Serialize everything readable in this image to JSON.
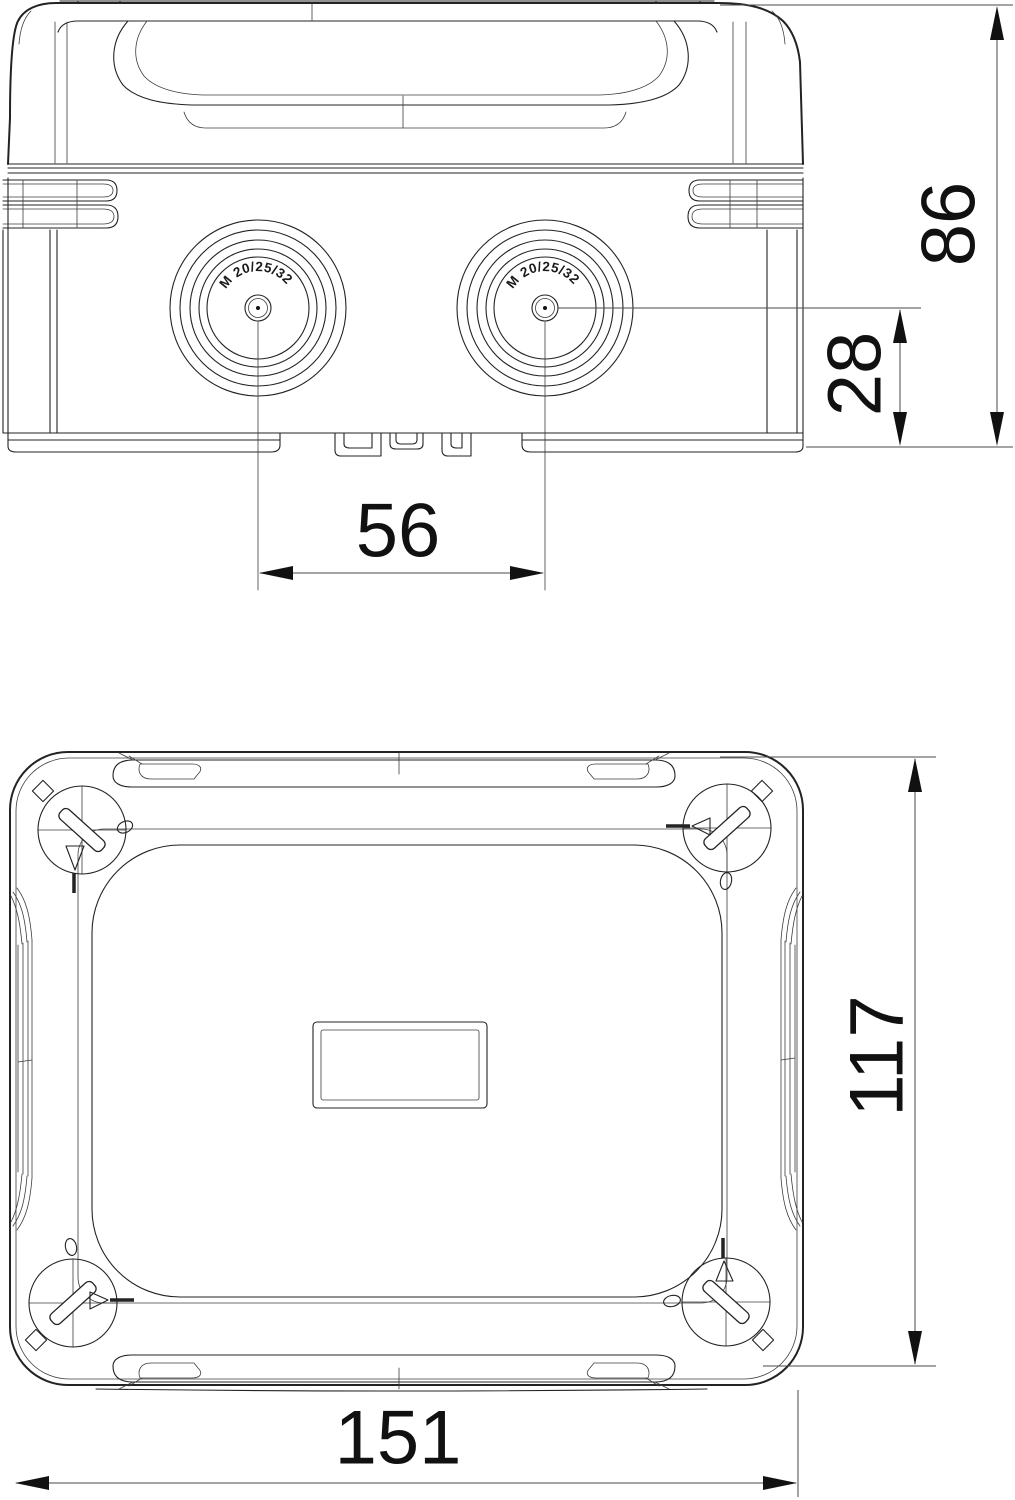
{
  "page": {
    "background": "#ffffff"
  },
  "drawing": {
    "type": "technical-dimension-drawing",
    "colors": {
      "line": "#232323",
      "thin_line": "#3d3d3d",
      "dimension_line": "#4a4a4a",
      "text": "#111111"
    },
    "side_view": {
      "knockout_left_label": "M 20/25/32",
      "knockout_right_label": "M 20/25/32",
      "dim_overall_height": "86",
      "dim_entry_center_height": "28",
      "dim_entry_spacing": "56"
    },
    "top_view": {
      "dim_overall_width": "117",
      "dim_overall_length": "151"
    }
  }
}
